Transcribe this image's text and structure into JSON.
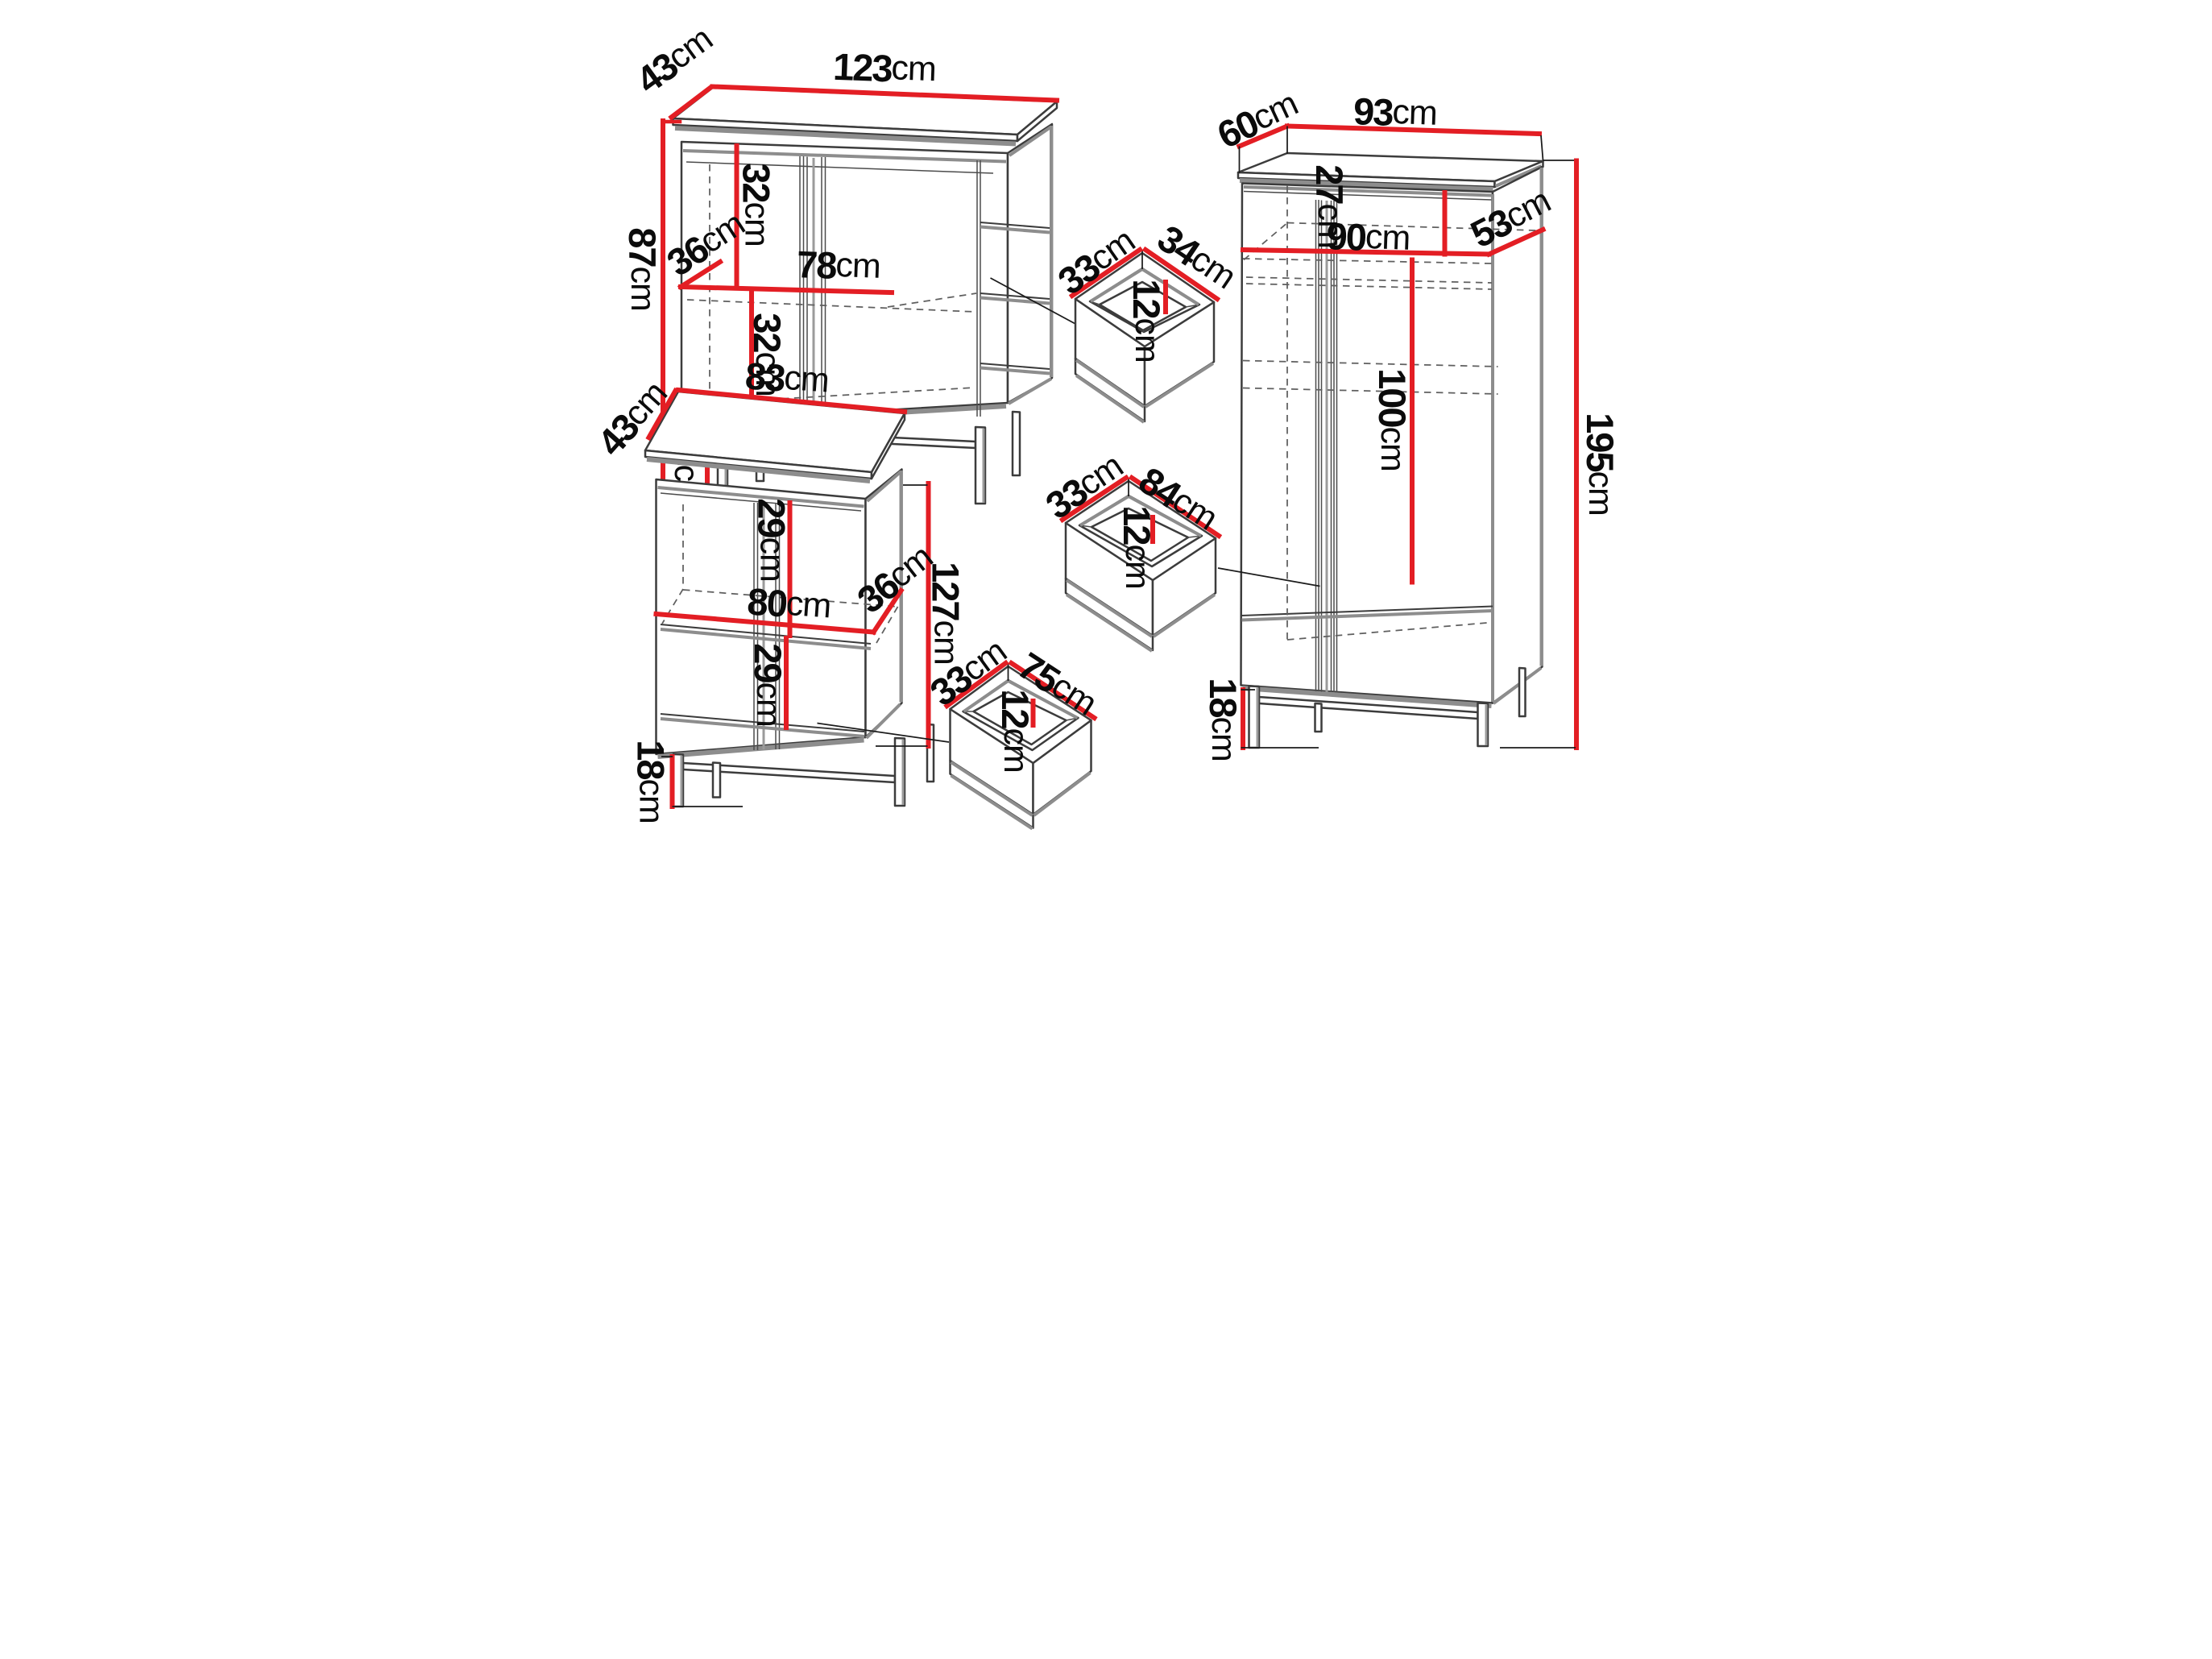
{
  "colors": {
    "dimension_line": "#e31e24",
    "outline": "#3c3c3c",
    "shadow_gray": "#8d8d8d",
    "hidden_line_gray": "#5f5f5f",
    "label_text": "#0b0b0b",
    "background": "#ffffff"
  },
  "furniture": {
    "sideboard": {
      "width": {
        "value": "123",
        "unit": "cm"
      },
      "depth": {
        "value": "43",
        "unit": "cm"
      },
      "height": {
        "value": "87",
        "unit": "cm"
      },
      "upper_section": {
        "value": "32",
        "unit": "cm"
      },
      "shelf_width": {
        "value": "78",
        "unit": "cm"
      },
      "shelf_depth": {
        "value": "36",
        "unit": "cm"
      },
      "lower_section": {
        "value": "32",
        "unit": "cm"
      },
      "leg_height": {
        "value": "18",
        "unit": "cm"
      }
    },
    "highboard": {
      "width": {
        "value": "83",
        "unit": "cm"
      },
      "depth": {
        "value": "43",
        "unit": "cm"
      },
      "height": {
        "value": "127",
        "unit": "cm"
      },
      "upper_section": {
        "value": "29",
        "unit": "cm"
      },
      "shelf_width": {
        "value": "80",
        "unit": "cm"
      },
      "shelf_depth": {
        "value": "36",
        "unit": "cm"
      },
      "lower_section": {
        "value": "29",
        "unit": "cm"
      },
      "leg_height": {
        "value": "18",
        "unit": "cm"
      }
    },
    "wardrobe": {
      "width": {
        "value": "93",
        "unit": "cm"
      },
      "depth": {
        "value": "60",
        "unit": "cm"
      },
      "height": {
        "value": "195",
        "unit": "cm"
      },
      "top_section": {
        "value": "27",
        "unit": "cm"
      },
      "shelf_width": {
        "value": "90",
        "unit": "cm"
      },
      "shelf_depth": {
        "value": "53",
        "unit": "cm"
      },
      "hanging_height": {
        "value": "100",
        "unit": "cm"
      },
      "leg_height": {
        "value": "18",
        "unit": "cm"
      }
    },
    "drawer_small": {
      "depth": {
        "value": "33",
        "unit": "cm"
      },
      "width": {
        "value": "34",
        "unit": "cm"
      },
      "height": {
        "value": "12",
        "unit": "cm"
      }
    },
    "drawer_wide": {
      "depth": {
        "value": "33",
        "unit": "cm"
      },
      "width": {
        "value": "84",
        "unit": "cm"
      },
      "height": {
        "value": "12",
        "unit": "cm"
      }
    },
    "drawer_medium": {
      "depth": {
        "value": "33",
        "unit": "cm"
      },
      "width": {
        "value": "75",
        "unit": "cm"
      },
      "height": {
        "value": "12",
        "unit": "cm"
      }
    }
  }
}
